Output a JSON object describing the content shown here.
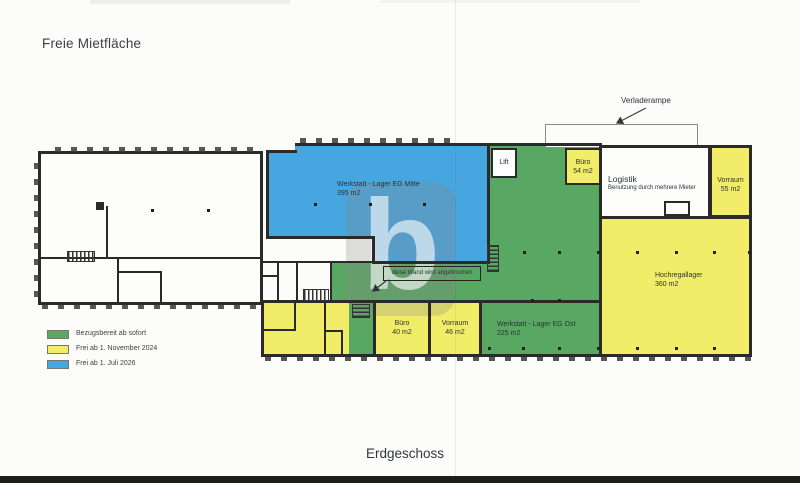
{
  "page": {
    "title": "Freie Mietfläche",
    "caption": "Erdgeschoss",
    "watermark": "b"
  },
  "colors": {
    "available_now": "#58A762",
    "free_nov_2024": "#F2ED68",
    "free_jul_2026": "#46A6DF"
  },
  "legend": {
    "items": [
      {
        "label": "Bezugsbereit ab sofort"
      },
      {
        "label": "Frei ab 1. November 2024"
      },
      {
        "label": "Frei ab 1. Juli 2026"
      }
    ]
  },
  "rooms": {
    "werkstatt_mitte": {
      "name": "Werkstatt - Lager EG Mitte",
      "area": "395 m2"
    },
    "lift": {
      "name": "Lift"
    },
    "buero_54": {
      "name": "Büro",
      "area": "54 m2"
    },
    "logistik": {
      "name": "Logistik",
      "note": "Benutzung durch mehrere Mieter"
    },
    "vorraum_55": {
      "name": "Vorraum",
      "area": "55 m2"
    },
    "hochregallager": {
      "name": "Hochregallager",
      "area": "360 m2"
    },
    "buero_40": {
      "name": "Büro",
      "area": "40 m2"
    },
    "vorraum_46": {
      "name": "Vorraum",
      "area": "46 m2"
    },
    "werkstatt_ost": {
      "name": "Werkstatt - Lager EG Ost",
      "area": "225 m2"
    }
  },
  "annotations": {
    "verladerampe": "Verladerampe",
    "wall_demolition": "diese Wand wird abgebrochen"
  }
}
